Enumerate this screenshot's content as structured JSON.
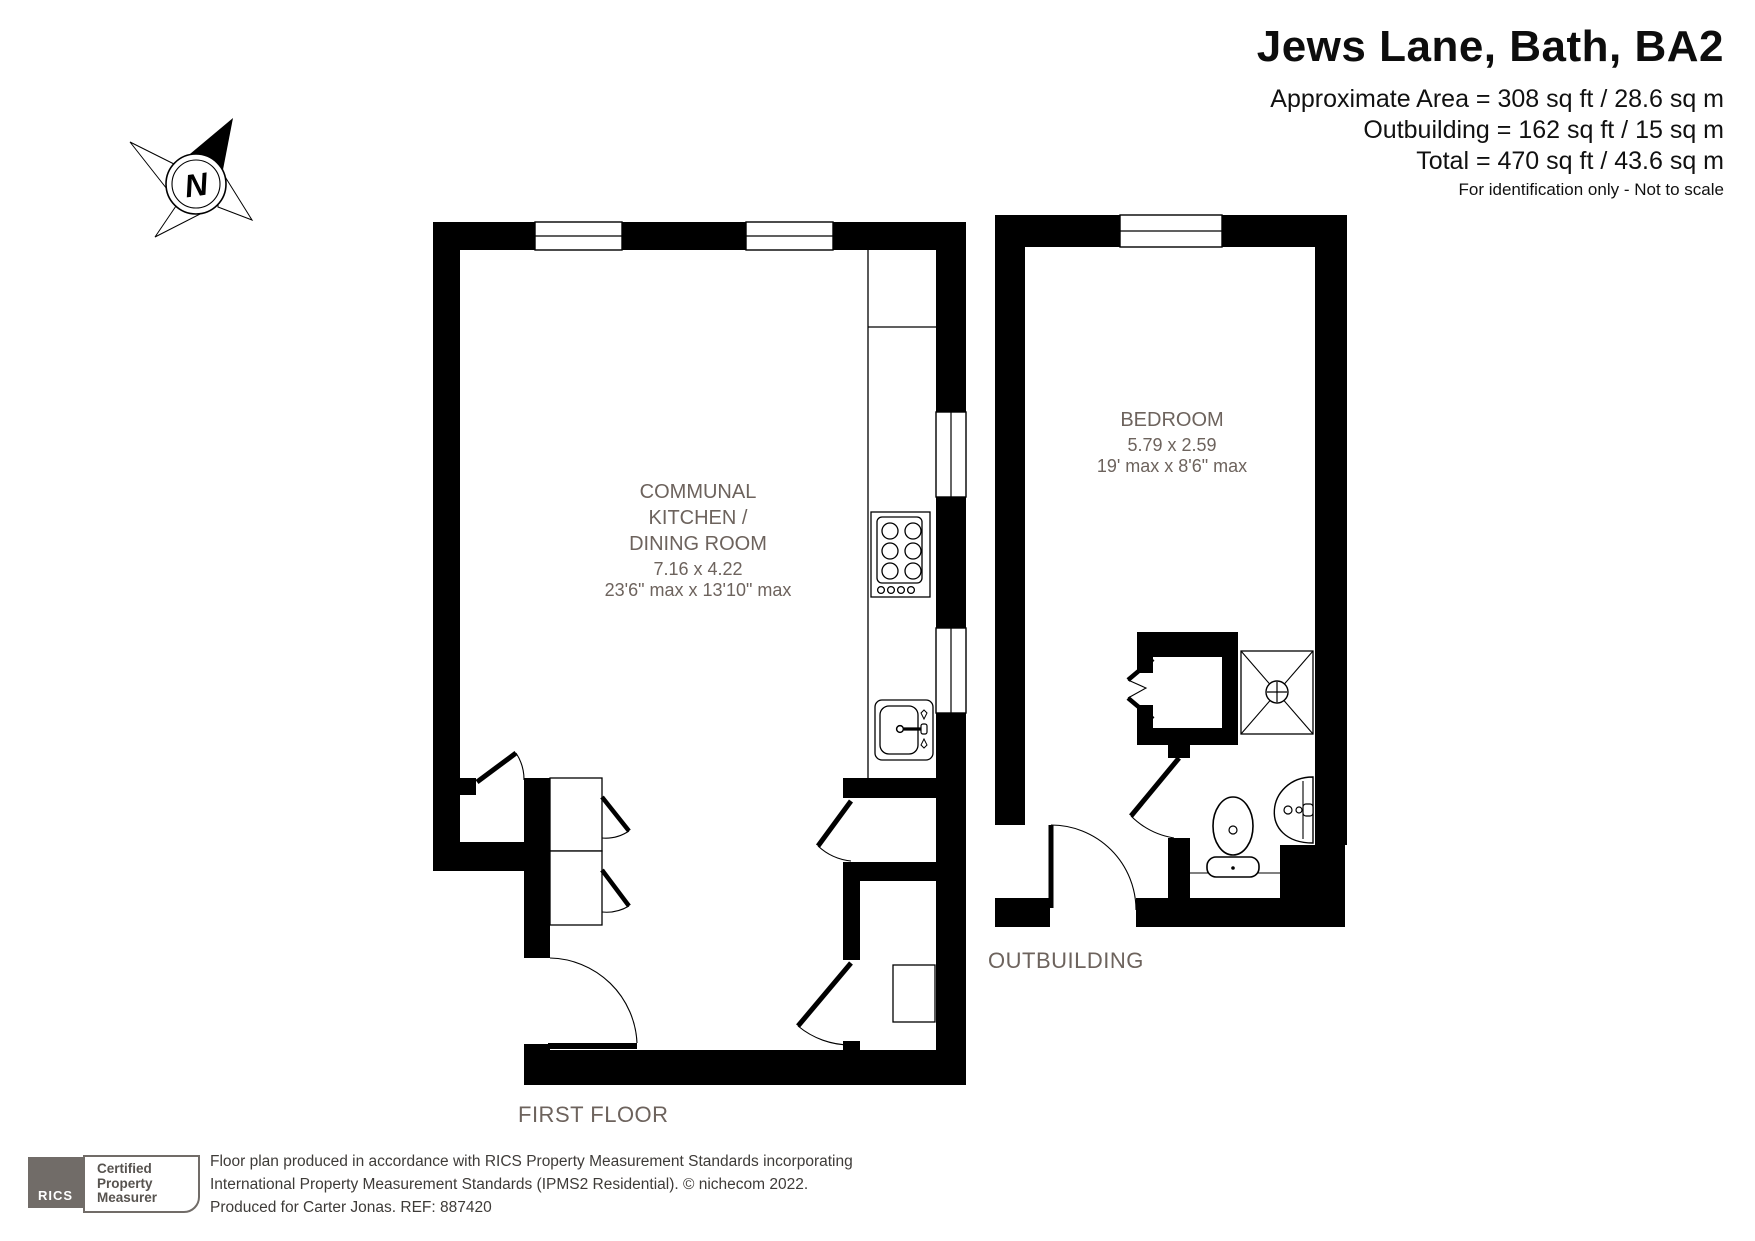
{
  "header": {
    "title": "Jews Lane, Bath, BA2",
    "area_lines": [
      "Approximate Area = 308 sq ft / 28.6 sq m",
      "Outbuilding = 162 sq ft / 15 sq m",
      "Total = 470 sq ft / 43.6 sq m"
    ],
    "disclaimer": "For identification only - Not to scale"
  },
  "compass": {
    "north_label": "N"
  },
  "plans": {
    "first_floor": {
      "label": "FIRST FLOOR",
      "room": {
        "name_lines": [
          "COMMUNAL",
          "KITCHEN /",
          "DINING ROOM"
        ],
        "dims_metric": "7.16 x 4.22",
        "dims_imperial": "23'6\" max x 13'10\" max"
      }
    },
    "outbuilding": {
      "label": "OUTBUILDING",
      "room": {
        "name": "BEDROOM",
        "dims_metric": "5.79 x 2.59",
        "dims_imperial": "19' max x 8'6\" max"
      }
    }
  },
  "badge": {
    "org": "RICS",
    "lines": [
      "Certified",
      "Property",
      "Measurer"
    ]
  },
  "footer": {
    "lines": [
      "Floor plan produced in accordance with RICS Property Measurement Standards incorporating",
      "International Property Measurement Standards (IPMS2 Residential).   © nichecom 2022.",
      "Produced for Carter Jonas.   REF:  887420"
    ]
  },
  "colors": {
    "wall": "#000000",
    "room_label": "#6d635d",
    "badge_gray": "#716c68",
    "badge_text": "#57534f"
  }
}
